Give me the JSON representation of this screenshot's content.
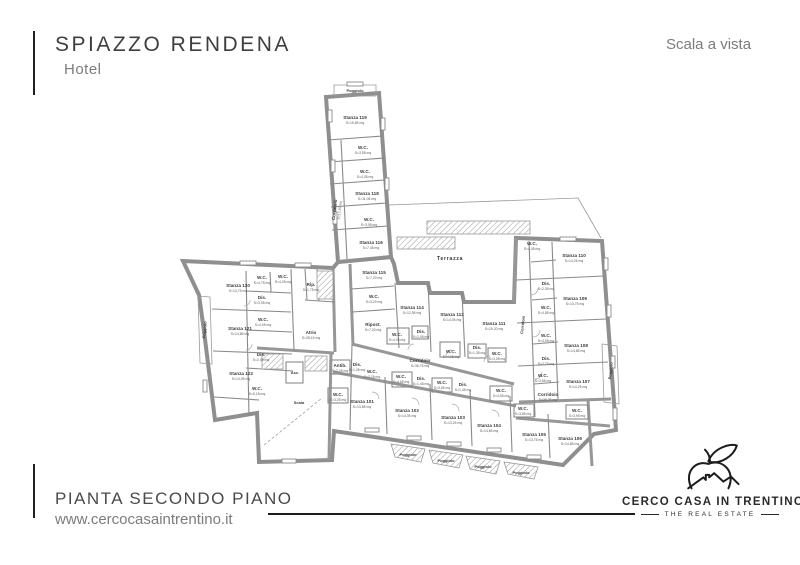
{
  "header": {
    "title": "SPIAZZO RENDENA",
    "subtitle": "Hotel",
    "scale_note": "Scala a vista"
  },
  "footer": {
    "plan_title": "PIANTA SECONDO PIANO",
    "website": "www.cercocasaintrentino.it"
  },
  "brand": {
    "name": "CERCO CASA IN TRENTINO",
    "tagline": "THE REAL ESTATE",
    "logo_icon": "bird-over-house-logo"
  },
  "colors": {
    "accent_black": "#1c1c1c",
    "text_gray": "#7c7c7c",
    "wall_gray": "#8f8f8f"
  },
  "floorplan": {
    "description": "Second-floor plan of hotel with rooms Stanza 101-122, bathrooms, corridors, stairs, terrace and balconies",
    "labels": [
      {
        "t": "Poggiolo",
        "x": 355,
        "y": 92,
        "s": "sm"
      },
      {
        "t": "Stanza 119",
        "a": "S=15,85 mq",
        "x": 355,
        "y": 119
      },
      {
        "t": "W.C.",
        "a": "S=3,55 mq",
        "x": 363,
        "y": 149
      },
      {
        "t": "W.C.",
        "a": "S=4,05 mq",
        "x": 365,
        "y": 173
      },
      {
        "t": "Corridoio",
        "a": "S=17,35 mq",
        "x": 336,
        "y": 210,
        "r": -84
      },
      {
        "t": "Stanza 118",
        "a": "S=11,05 mq",
        "x": 367,
        "y": 195
      },
      {
        "t": "W.C.",
        "a": "S=3,05 mq",
        "x": 369,
        "y": 221
      },
      {
        "t": "Stanza 116",
        "a": "S=7,45 mq",
        "x": 371,
        "y": 244
      },
      {
        "t": "Stanza 115",
        "a": "S=7,20 mq",
        "x": 374,
        "y": 274
      },
      {
        "t": "W.C.",
        "a": "S=3,20 mq",
        "x": 374,
        "y": 298
      },
      {
        "t": "Ripost.",
        "a": "S=7,20 mq",
        "x": 373,
        "y": 326
      },
      {
        "t": "Terrazza",
        "x": 450,
        "y": 260,
        "s": "md"
      },
      {
        "t": "Stanza 114",
        "a": "S=12,95 mq",
        "x": 412,
        "y": 309
      },
      {
        "t": "W.C.",
        "a": "S=4,05 mq",
        "x": 397,
        "y": 336
      },
      {
        "t": "Dis.",
        "a": "S=2,05 mq",
        "x": 421,
        "y": 333
      },
      {
        "t": "Stanza 112",
        "a": "S=14,05 mq",
        "x": 452,
        "y": 316
      },
      {
        "t": "W.C.",
        "a": "S=4,05 mq",
        "x": 451,
        "y": 353
      },
      {
        "t": "Dis.",
        "a": "S=1,35 mq",
        "x": 477,
        "y": 349
      },
      {
        "t": "Stanza 111",
        "a": "S=15,20 mq",
        "x": 494,
        "y": 325
      },
      {
        "t": "W.C.",
        "a": "S=3,05 mq",
        "x": 497,
        "y": 355
      },
      {
        "t": "Corridoio",
        "a": "S=36,75 mq",
        "x": 420,
        "y": 362
      },
      {
        "t": "W.C.",
        "a": "S=4,05 mq",
        "x": 532,
        "y": 245
      },
      {
        "t": "Stanza 110",
        "a": "S=14,25 mq",
        "x": 574,
        "y": 257
      },
      {
        "t": "Dis.",
        "a": "S=2,05 mq",
        "x": 546,
        "y": 285
      },
      {
        "t": "Stanza 109",
        "a": "S=13,75 mq",
        "x": 575,
        "y": 300
      },
      {
        "t": "W.C.",
        "a": "S=4,85 mq",
        "x": 546,
        "y": 309
      },
      {
        "t": "W.C.",
        "a": "S=4,05 mq",
        "x": 546,
        "y": 337
      },
      {
        "t": "Stanza 108",
        "a": "S=14,85 mq",
        "x": 576,
        "y": 347
      },
      {
        "t": "Dis.",
        "a": "S=2,75 mq",
        "x": 546,
        "y": 360
      },
      {
        "t": "W.C.",
        "a": "S=3,65 mq",
        "x": 543,
        "y": 377
      },
      {
        "t": "Stanza 107",
        "a": "S=14,25 mq",
        "x": 578,
        "y": 383
      },
      {
        "t": "Corridoio",
        "x": 524,
        "y": 325,
        "r": -84,
        "s": "sm"
      },
      {
        "t": "Poggiolo",
        "x": 612,
        "y": 371,
        "r": -84,
        "s": "sm"
      },
      {
        "t": "Corridoio",
        "a": "S=26,75 mq",
        "x": 548,
        "y": 396
      },
      {
        "t": "Atrio",
        "a": "S=28,15 mq",
        "x": 311,
        "y": 334
      },
      {
        "t": "Rip.",
        "a": "S=1,75 mq",
        "x": 311,
        "y": 286
      },
      {
        "t": "Stanza 120",
        "a": "S=13,75 mq",
        "x": 238,
        "y": 287
      },
      {
        "t": "W.C.",
        "a": "S=4,75 mq",
        "x": 262,
        "y": 279
      },
      {
        "t": "W.C.",
        "a": "S=4,05 mq",
        "x": 283,
        "y": 278
      },
      {
        "t": "Dis.",
        "a": "S=3,05 mq",
        "x": 262,
        "y": 299
      },
      {
        "t": "Stanza 121",
        "a": "S=14,85 mq",
        "x": 240,
        "y": 330
      },
      {
        "t": "W.C.",
        "a": "S=4,05 mq",
        "x": 263,
        "y": 321
      },
      {
        "t": "Dis.",
        "a": "S=2,05 mq",
        "x": 261,
        "y": 356
      },
      {
        "t": "Stanza 122",
        "a": "S=13,05 mq",
        "x": 241,
        "y": 375
      },
      {
        "t": "W.C.",
        "a": "S=5,18 mq",
        "x": 257,
        "y": 390
      },
      {
        "t": "Poggiolo",
        "x": 206,
        "y": 330,
        "r": -85,
        "s": "sm"
      },
      {
        "t": "Asc.",
        "x": 295,
        "y": 374,
        "s": "sm"
      },
      {
        "t": "Scala",
        "x": 299,
        "y": 404,
        "s": "sm"
      },
      {
        "t": "Antib.",
        "a": "S=3,05 mq",
        "x": 340,
        "y": 367
      },
      {
        "t": "W.C.",
        "a": "S=3,25 mq",
        "x": 338,
        "y": 396
      },
      {
        "t": "Dis.",
        "a": "S=1,05 mq",
        "x": 357,
        "y": 366
      },
      {
        "t": "W.C.",
        "a": "S=3,25 mq",
        "x": 372,
        "y": 373
      },
      {
        "t": "Stanza 101",
        "a": "S=13,85 mq",
        "x": 362,
        "y": 403
      },
      {
        "t": "W.C.",
        "a": "S=4,65 mq",
        "x": 401,
        "y": 378
      },
      {
        "t": "Dis.",
        "a": "S=1,45 mq",
        "x": 421,
        "y": 380
      },
      {
        "t": "Stanza 102",
        "a": "S=14,05 mq",
        "x": 407,
        "y": 412
      },
      {
        "t": "W.C.",
        "a": "S=3,55 mq",
        "x": 442,
        "y": 384
      },
      {
        "t": "Dis.",
        "a": "S=1,45 mq",
        "x": 463,
        "y": 386
      },
      {
        "t": "Stanza 103",
        "a": "S=13,25 mq",
        "x": 453,
        "y": 419
      },
      {
        "t": "W.C.",
        "a": "S=4,55 mq",
        "x": 501,
        "y": 392
      },
      {
        "t": "Stanza 104",
        "a": "S=14,65 mq",
        "x": 489,
        "y": 427
      },
      {
        "t": "W.C.",
        "a": "S=3,85 mq",
        "x": 523,
        "y": 410
      },
      {
        "t": "Stanza 105",
        "a": "S=13,75 mq",
        "x": 534,
        "y": 436
      },
      {
        "t": "W.C.",
        "a": "S=3,95 mq",
        "x": 577,
        "y": 412
      },
      {
        "t": "Stanza 106",
        "a": "S=14,85 mq",
        "x": 570,
        "y": 440
      },
      {
        "t": "Poggiolo",
        "x": 408,
        "y": 456,
        "s": "sm"
      },
      {
        "t": "Poggiolo",
        "x": 446,
        "y": 462,
        "s": "sm"
      },
      {
        "t": "Poggiolo",
        "x": 483,
        "y": 468,
        "s": "sm"
      },
      {
        "t": "Poggiolo",
        "x": 521,
        "y": 474,
        "s": "sm"
      }
    ]
  }
}
